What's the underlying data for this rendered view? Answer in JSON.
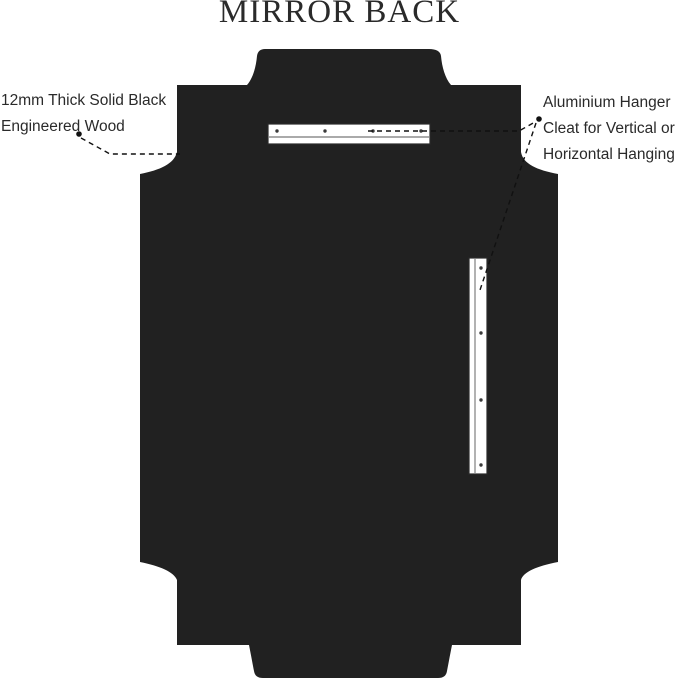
{
  "title": "MIRROR BACK",
  "annotations": {
    "left": {
      "lines": [
        "12mm Thick Solid Black",
        "Engineered Wood"
      ]
    },
    "right": {
      "lines": [
        "Aluminium Hanger",
        "Cleat for Vertical or",
        "Horizontal Hanging"
      ]
    }
  },
  "colors": {
    "background": "#ffffff",
    "panel": "#212121",
    "text": "#2a2a2a",
    "line": "#111111",
    "cleat_fill": "#ffffff",
    "cleat_stroke": "#2b2b2b"
  }
}
